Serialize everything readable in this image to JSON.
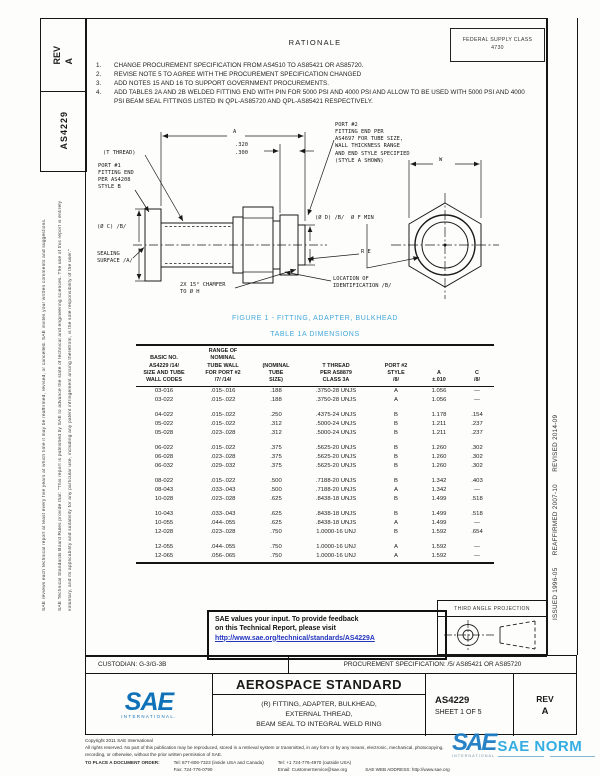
{
  "colors": {
    "caption_blue": "#44a8da",
    "link_blue": "#2335bd",
    "sae_blue": "#0f72b8",
    "watermark_blue": "#2aa9e1"
  },
  "left_margin": {
    "rev": "REV\nA",
    "doc_number": "AS4229",
    "disclaimer_1": "SAE Technical Standards Board Rules provide that: \"This report is published by SAE to advance the state of technical and engineering sciences. The use of this report is entirely",
    "disclaimer_2": "voluntary, and its applicability and suitability for any particular use, including any patent infringement arising therefrom, is the sole responsibility of the user.\"",
    "disclaimer_3": "SAE reviews each technical report at least every five years at which time it may be reaffirmed, revised, or cancelled. SAE invites your written comments and suggestions."
  },
  "right_margin": {
    "history": "ISSUED 1996-05      REAFFIRMED 2007-10      REVISED 2014-09"
  },
  "header": {
    "fsc_line1": "FEDERAL SUPPLY CLASS",
    "fsc_line2": "4730"
  },
  "rationale": {
    "title": "RATIONALE",
    "items": [
      {
        "num": "1.",
        "text": "CHANGE PROCUREMENT SPECIFICATION FROM AS4510 TO AS85421 OR AS85720."
      },
      {
        "num": "2.",
        "text": "REVISE NOTE 5 TO AGREE WITH THE PROCUREMENT SPECIFICATION CHANGED"
      },
      {
        "num": "3.",
        "text": "ADD NOTES 15 AND 16 TO SUPPORT GOVERNMENT PROCUREMENTS."
      },
      {
        "num": "4.",
        "text": "ADD TABLES 2A AND 2B WELDED FITTING END WITH PIN FOR 5000 PSI AND 4000 PSI AND ALLOW TO BE USED WITH 5000 PSI AND 4000 PSI BEAM SEAL FITTINGS LISTED IN QPL-AS85720 AND QPL-AS85421 RESPECTIVELY."
      }
    ]
  },
  "figure": {
    "caption": "FIGURE 1 - FITTING, ADAPTER, BULKHEAD",
    "labels": {
      "t_thread": "(T THREAD)",
      "port1": "PORT #1\nFITTING END\nPER AS4208\nSTYLE B",
      "dim_320": ".320",
      "dim_300": ".300",
      "dim_a": "A",
      "port2": "PORT #2\nFITTING END PER\nAS4697 FOR TUBE SIZE,\nWALL THICKNESS RANGE\nAND END STYLE SPECIFIED\n(STYLE A SHOWN)",
      "dim_w": "W",
      "dia_c": "(Ø C)  /B/",
      "dia_d": "(Ø D)  /B/",
      "dia_f": "Ø F MIN",
      "sealing": "SEALING\nSURFACE /A/",
      "r_e": "R E",
      "chamfer": "2X 15° CHAMFER\nTO Ø H",
      "location": "LOCATION OF\nIDENTIFICATION /B/"
    }
  },
  "table": {
    "caption": "TABLE 1A  DIMENSIONS",
    "headers": [
      "BASIC NO.\nAS4229 /14/\nSIZE AND TUBE\nWALL CODES",
      "RANGE OF\nNOMINAL\nTUBE WALL\nFOR PORT #2\n/7/ /14/",
      "(NOMINAL\nTUBE\nSIZE)",
      "T THREAD\nPER AS8879\nCLASS 3A",
      "PORT #2\nSTYLE\n/8/",
      "A\n±.010",
      "C\n/8/"
    ],
    "rows": [
      [
        "03-016",
        ".015-.016",
        ".188",
        ".3750-28 UNJS",
        "A",
        "1.056",
        "—"
      ],
      [
        "03-022",
        ".015-.022",
        ".188",
        ".3750-28 UNJS",
        "A",
        "1.056",
        "—"
      ],
      [
        "04-022",
        ".015-.022",
        ".250",
        ".4375-24 UNJS",
        "B",
        "1.178",
        ".154"
      ],
      [
        "05-022",
        ".015-.022",
        ".312",
        ".5000-24 UNJS",
        "B",
        "1.211",
        ".237"
      ],
      [
        "05-028",
        ".023-.028",
        ".312",
        ".5000-24 UNJS",
        "B",
        "1.211",
        ".237"
      ],
      [
        "06-022",
        ".015-.022",
        ".375",
        ".5625-20 UNJS",
        "B",
        "1.260",
        ".302"
      ],
      [
        "06-028",
        ".023-.028",
        ".375",
        ".5625-20 UNJS",
        "B",
        "1.260",
        ".302"
      ],
      [
        "06-032",
        ".029-.032",
        ".375",
        ".5625-20 UNJS",
        "B",
        "1.260",
        ".302"
      ],
      [
        "08-022",
        ".015-.022",
        ".500",
        ".7188-20 UNJS",
        "B",
        "1.342",
        ".403"
      ],
      [
        "08-043",
        ".033-.043",
        ".500",
        ".7188-20 UNJS",
        "A",
        "1.342",
        "—"
      ],
      [
        "10-028",
        ".023-.028",
        ".625",
        ".8438-18 UNJS",
        "B",
        "1.499",
        ".518"
      ],
      [
        "10-043",
        ".033-.043",
        ".625",
        ".8438-18 UNJS",
        "B",
        "1.499",
        ".518"
      ],
      [
        "10-055",
        ".044-.055",
        ".625",
        ".8438-18 UNJS",
        "A",
        "1.499",
        "—"
      ],
      [
        "12-028",
        ".023-.028",
        ".750",
        "1.0000-16 UNJ",
        "B",
        "1.592",
        ".654"
      ],
      [
        "12-055",
        ".044-.055",
        ".750",
        "1.0000-16 UNJ",
        "A",
        "1.592",
        "—"
      ],
      [
        "12-065",
        ".056-.065",
        ".750",
        "1.0000-16 UNJ",
        "A",
        "1.592",
        "—"
      ]
    ]
  },
  "feedback": {
    "line1": "SAE values your input. To provide feedback",
    "line2": "on this Technical Report, please visit",
    "link": "http://www.sae.org/technical/standards/AS4229A"
  },
  "projection": {
    "label": "THIRD ANGLE PROJECTION"
  },
  "title_block": {
    "custodian": "CUSTODIAN: G-3/G-3B",
    "procurement": "PROCUREMENT SPECIFICATION: /5/ AS85421 OR AS85720",
    "logo_text": "SAE",
    "logo_sub": "INTERNATIONAL.",
    "standard_type": "AEROSPACE STANDARD",
    "title_line1": "(R) FITTING, ADAPTER, BULKHEAD,",
    "title_line2": "EXTERNAL THREAD,",
    "title_line3": "BEAM SEAL TO INTEGRAL WELD RING",
    "doc_number": "AS4229",
    "sheet": "SHEET 1 OF 5",
    "rev_label": "REV",
    "rev_value": "A"
  },
  "footer": {
    "copyright": "Copyright 2011 SAE International",
    "rights_1": "All rights reserved. No part of this publication may be reproduced, stored in a retrieval system or transmitted, in any form or by any means, electronic, mechanical, photocopying,",
    "rights_2": "recording, or otherwise, without the prior written permission of SAE.",
    "order_label": "TO PLACE A DOCUMENT ORDER:",
    "tel_inside": "Tel: 877-606-7323 (inside USA and Canada)",
    "fax": "Fax: 724-776-0790",
    "tel_outside": "Tel: +1 724-776-4970 (outside USA)",
    "email": "Email: CustomerService@sae.org",
    "web": "SAE WEB ADDRESS: http://www.sae.org"
  },
  "watermark": {
    "glyph": "SAE",
    "text": "SAE NORM",
    "sub": "INTERNATIONAL"
  }
}
